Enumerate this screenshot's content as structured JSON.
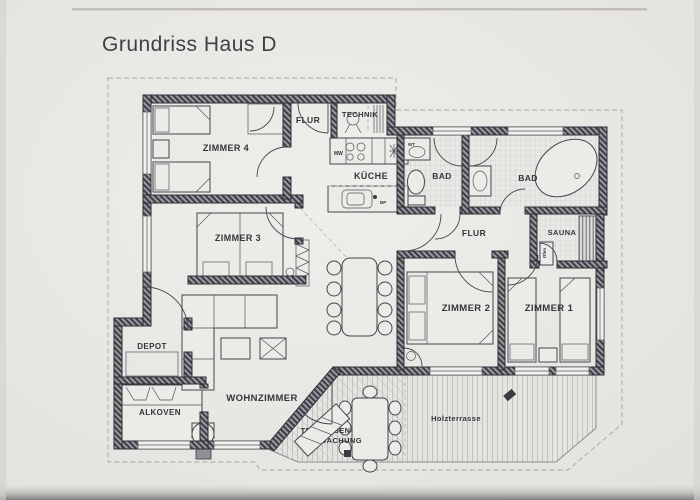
{
  "title": "Grundriss Haus D",
  "rooms": {
    "zimmer4": {
      "label": "ZIMMER 4"
    },
    "zimmer3": {
      "label": "ZIMMER 3"
    },
    "zimmer2": {
      "label": "ZIMMER 2"
    },
    "zimmer1": {
      "label": "ZIMMER 1"
    },
    "flur_top": {
      "label": "FLUR"
    },
    "flur_right": {
      "label": "FLUR"
    },
    "technik": {
      "label": "TECHNIK"
    },
    "kueche": {
      "label": "KÜCHE"
    },
    "bad_left": {
      "label": "BAD"
    },
    "bad_right": {
      "label": "BAD"
    },
    "sauna": {
      "label": "SAUNA"
    },
    "depot": {
      "label": "DEPOT"
    },
    "alkoven": {
      "label": "ALKOVEN"
    },
    "wohnzimmer": {
      "label": "WOHNZIMMER"
    }
  },
  "outdoor": {
    "terrasse_line1": "TERRASSEN-",
    "terrasse_line2": "ÜBERDACHUNG",
    "holzterrasse": "Holzterrasse"
  },
  "annotations": {
    "mw": "MW",
    "wt": "WT",
    "bp": "BP",
    "ofen": "Ofen"
  },
  "colors": {
    "paper": "#e9e7e3",
    "ink": "#34343b",
    "wall": "#8f8f96",
    "tile_line": "#c6c6ca"
  }
}
